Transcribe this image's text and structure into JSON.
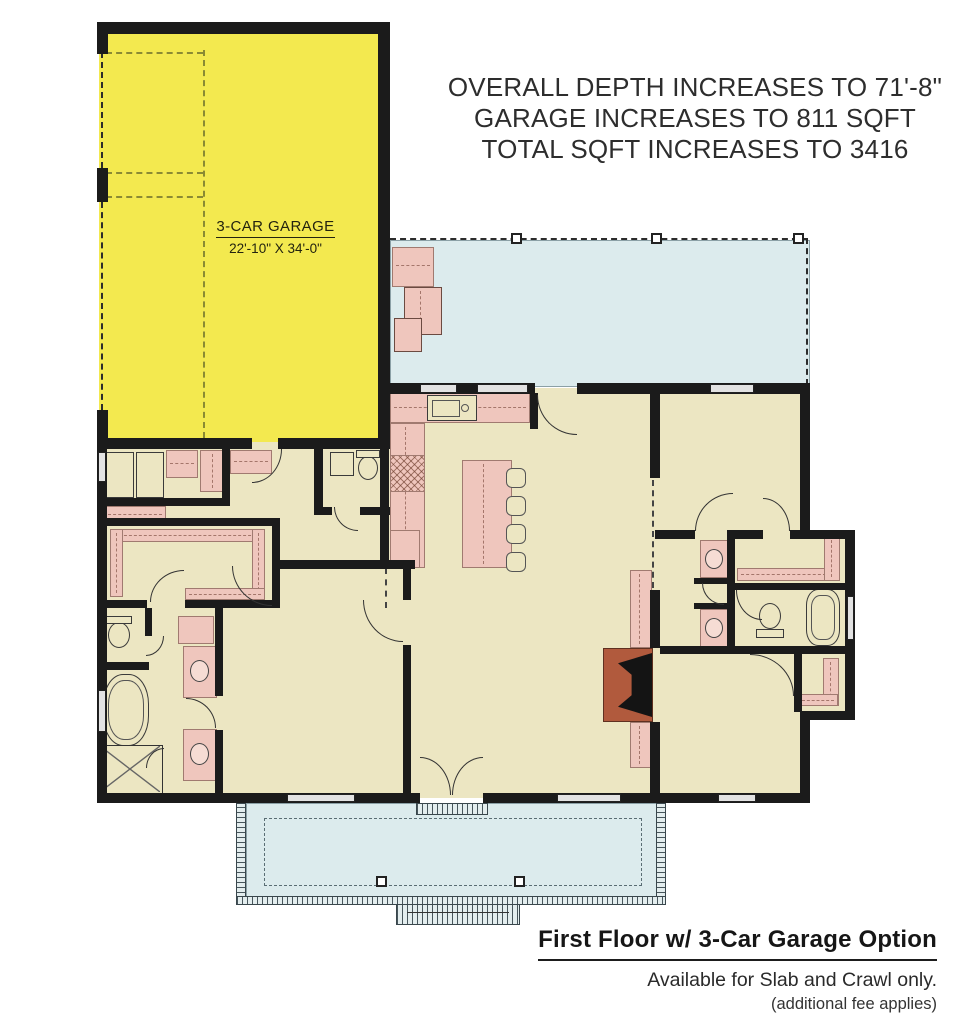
{
  "annotation": {
    "lines": [
      "OVERALL DEPTH INCREASES TO 71'-8\"",
      "GARAGE INCREASES TO 811 SQFT",
      "TOTAL SQFT INCREASES TO 3416"
    ]
  },
  "garage": {
    "label": "3-CAR GARAGE",
    "dimensions": "22'-10\" X 34'-0\""
  },
  "caption": {
    "title": "First Floor w/ 3-Car Garage Option",
    "availability": "Available for Slab and Crawl only.",
    "note": "(additional fee applies)"
  },
  "colors": {
    "garage_yellow": "#f3e94f",
    "floor_cream": "#ece6c2",
    "porch_blue": "#dcebed",
    "fixture_pink": "#efc6bd",
    "fireplace_red": "#b15a3d",
    "wall_black": "#1b1b1b"
  }
}
